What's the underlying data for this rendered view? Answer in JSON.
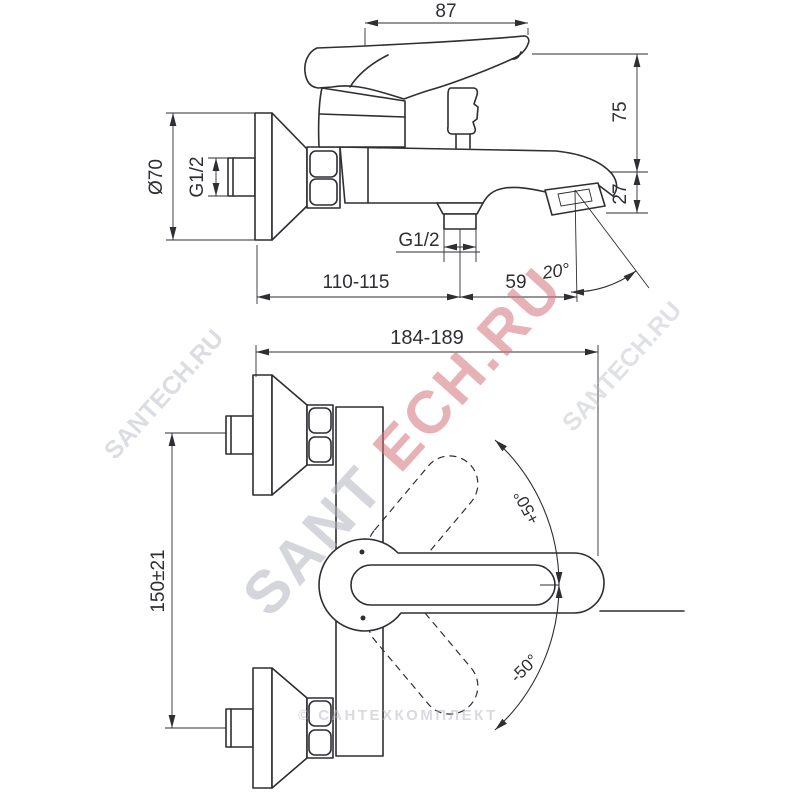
{
  "title": "bath mixer technical installation drawing",
  "colors": {
    "background": "#ffffff",
    "line": "#2e2e33",
    "watermark_red": "#d4747c",
    "watermark_gray": "#b3b6c0"
  },
  "side_view": {
    "dims": {
      "handle_length": "87",
      "height_above_spout": "75",
      "spout_drop": "27",
      "escutcheon_diameter": "Ø70",
      "inlet_thread": "G1/2",
      "shower_outlet_thread": "G1/2",
      "wall_to_shower_outlet": "110-115",
      "outlet_to_spout_tip": "59",
      "spout_angle": "20°"
    }
  },
  "front_view": {
    "dims": {
      "overall_width": "184-189",
      "inlet_spacing": "150±21",
      "handle_swing_up": "+50°",
      "handle_swing_down": "-50°"
    }
  },
  "watermarks": {
    "main_part1": "SANT",
    "main_part2": "ECH.RU",
    "small_left": "SANTECH.RU",
    "small_right": "SANTECH.RU",
    "bottom_credit": "© САНТЕХКОМПЛЕКТ"
  }
}
